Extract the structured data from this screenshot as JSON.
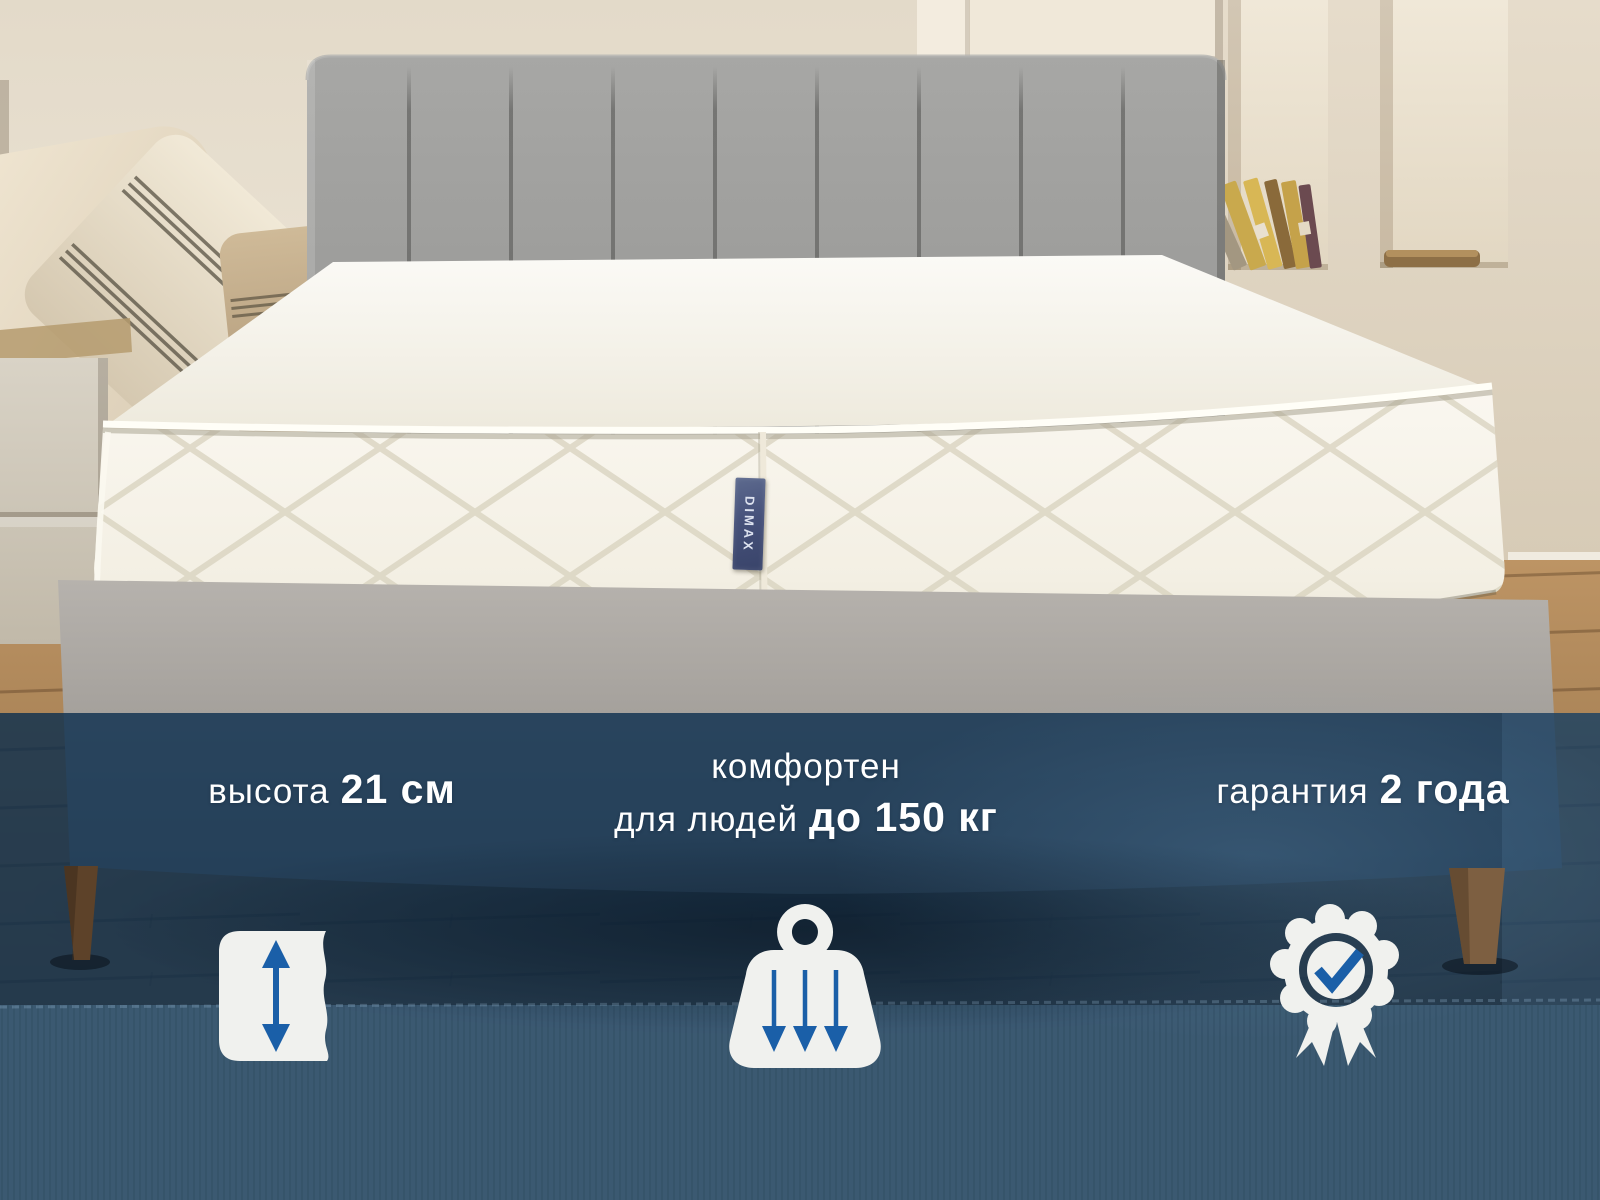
{
  "product": {
    "brand_label": "DIMAX"
  },
  "features": {
    "height": {
      "regular": "высота",
      "bold": "21 см"
    },
    "weight": {
      "line1": "комфортен",
      "line2_regular": "для людей",
      "line2_bold": "до 150 кг"
    },
    "warranty": {
      "regular": "гарантия",
      "bold": "2 года"
    }
  },
  "icons": [
    {
      "name": "mattress-height-icon",
      "meaning": "mattress height with vertical double arrow"
    },
    {
      "name": "weight-capacity-icon",
      "meaning": "weight with three down arrows"
    },
    {
      "name": "warranty-badge-icon",
      "meaning": "award rosette with checkmark and ribbons"
    }
  ],
  "colors": {
    "accent_blue": "#1a5fa8",
    "overlay_navy": "#0a2d4e",
    "icon_white": "#f0f1ee",
    "text_white": "#ffffff"
  }
}
